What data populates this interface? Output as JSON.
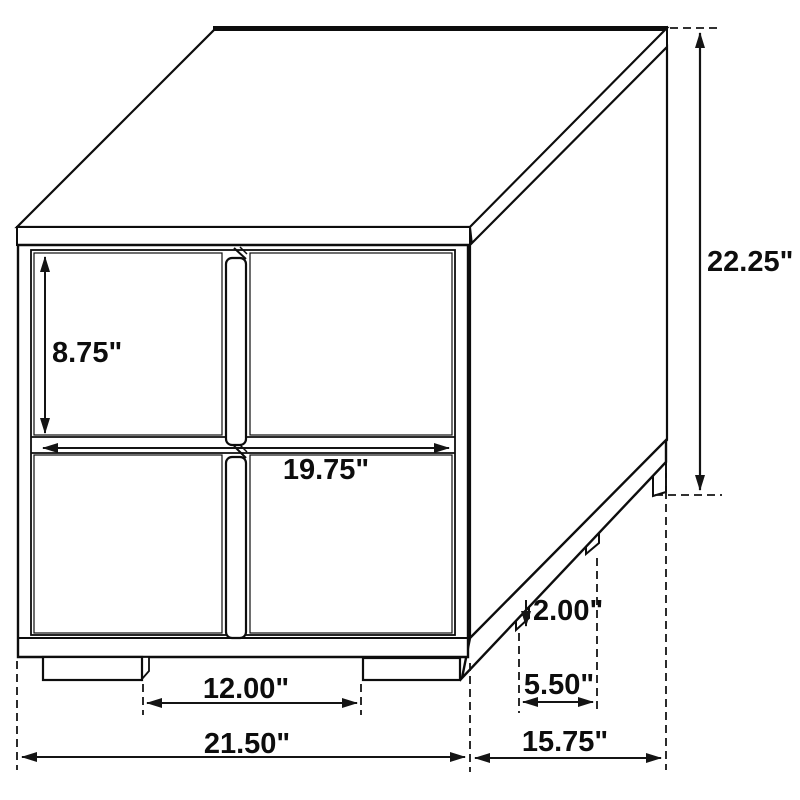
{
  "diagram": {
    "type": "furniture-dimension-drawing",
    "subject": "two-drawer-nightstand",
    "units": "inches",
    "line_color": "#0d0d0d",
    "background_color": "#ffffff",
    "labels": {
      "overall_height": "22.25\"",
      "drawer_front_height": "8.75\"",
      "drawer_area_width": "19.75\"",
      "leg_height": "2.00\"",
      "side_leg_gap": "5.50\"",
      "overall_depth": "15.75\"",
      "front_leg_gap": "12.00\"",
      "overall_width": "21.50\""
    }
  }
}
